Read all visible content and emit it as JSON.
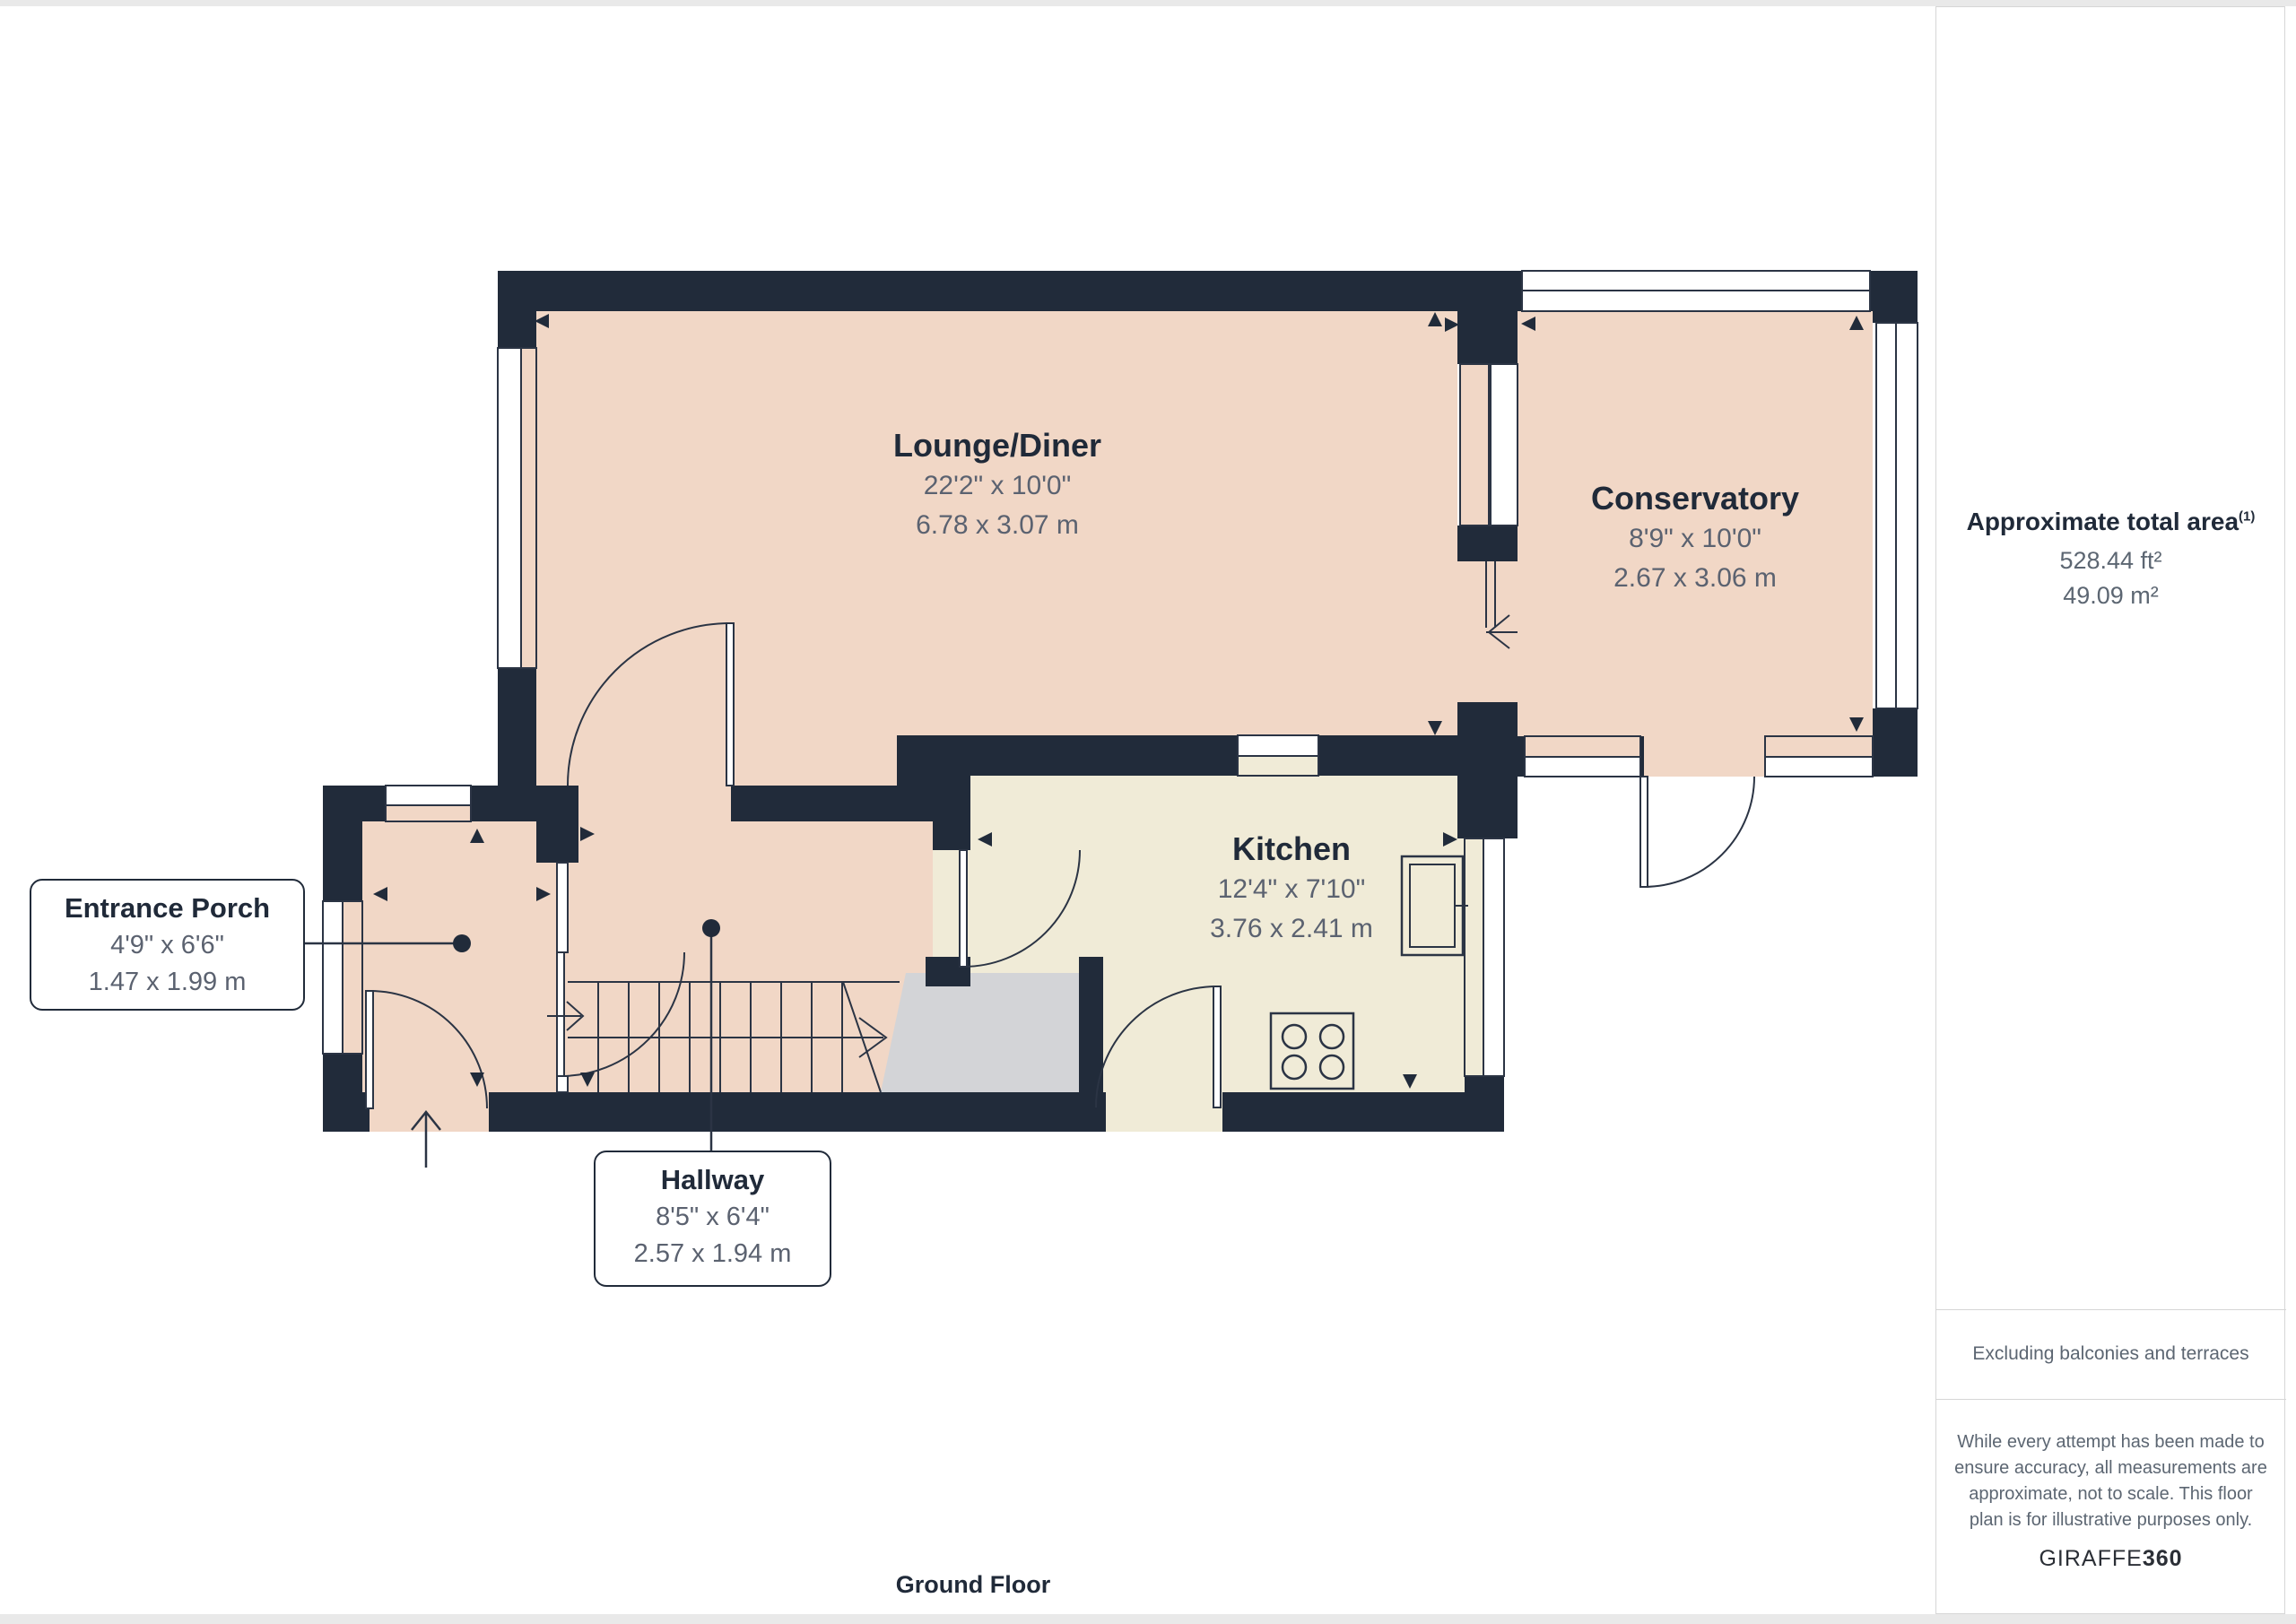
{
  "page": {
    "floor_label": "Ground Floor"
  },
  "rooms": {
    "lounge_diner": {
      "name": "Lounge/Diner",
      "imperial": "22'2\" x 10'0\"",
      "metric": "6.78 x 3.07 m"
    },
    "conservatory": {
      "name": "Conservatory",
      "imperial": "8'9\" x 10'0\"",
      "metric": "2.67 x 3.06 m"
    },
    "kitchen": {
      "name": "Kitchen",
      "imperial": "12'4\" x 7'10\"",
      "metric": "3.76 x 2.41 m"
    },
    "entrance_porch": {
      "name": "Entrance Porch",
      "imperial": "4'9\" x 6'6\"",
      "metric": "1.47 x 1.99 m"
    },
    "hallway": {
      "name": "Hallway",
      "imperial": "8'5\" x 6'4\"",
      "metric": "2.57 x 1.94 m"
    }
  },
  "sidebar": {
    "area_title": "Approximate total area",
    "area_sup": "(1)",
    "area_ft": "528.44 ft²",
    "area_m": "49.09 m²",
    "excluding": "Excluding balconies and terraces",
    "disclaimer_lines": [
      "While every attempt has been made to",
      "ensure accuracy, all measurements are",
      "approximate, not to scale. This floor",
      "plan is for illustrative purposes only."
    ],
    "brand_left": "GIRAFFE",
    "brand_right": "360"
  },
  "colors": {
    "wall": "#212B3A",
    "room_pink": "#F1D7C6",
    "kitchen_cream": "#F0EBD7",
    "stairs_gray": "#D3D4D7",
    "title_text": "#202A39",
    "dim_text": "#5B6270",
    "muted_text": "#5C6672",
    "brand_text": "#2B2F36",
    "line": "#2B3444",
    "frame_gray": "#E9E9E9",
    "divider_gray": "#D6D6D6"
  }
}
